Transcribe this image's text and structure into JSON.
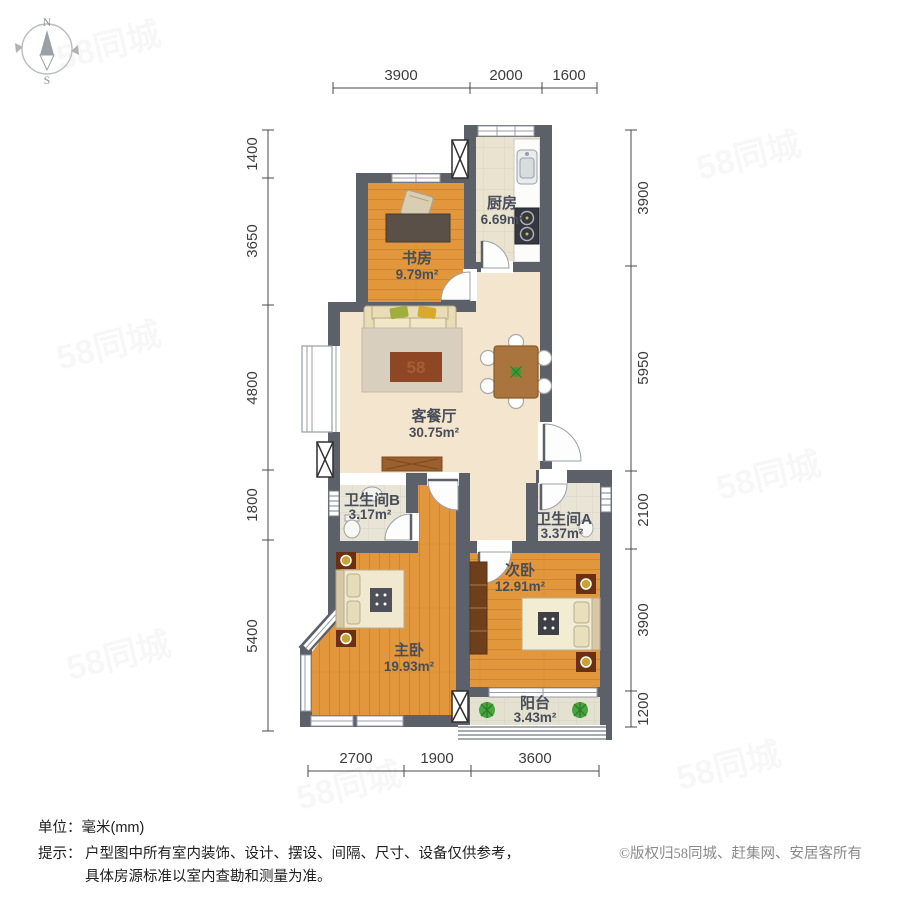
{
  "compass": {
    "north": "N",
    "south": "S"
  },
  "watermark": {
    "text": "58同城",
    "rug_text": "58"
  },
  "dimensions": {
    "top": [
      "3900",
      "2000",
      "1600"
    ],
    "left": [
      "1400",
      "3650",
      "4800",
      "1800",
      "5400"
    ],
    "right": [
      "3900",
      "5950",
      "2100",
      "3900",
      "1200"
    ],
    "bottom": [
      "2700",
      "1900",
      "3600"
    ]
  },
  "rooms": [
    {
      "name": "厨房",
      "area": "6.69m²"
    },
    {
      "name": "书房",
      "area": "9.79m²"
    },
    {
      "name": "客餐厅",
      "area": "30.75m²"
    },
    {
      "name": "卫生间B",
      "area": "3.17m²"
    },
    {
      "name": "卫生间A",
      "area": "3.37m²"
    },
    {
      "name": "次卧",
      "area": "12.91m²"
    },
    {
      "name": "主卧",
      "area": "19.93m²"
    },
    {
      "name": "阳台",
      "area": "3.43m²"
    }
  ],
  "footer": {
    "unit_label": "单位：",
    "unit_value": "毫米(mm)",
    "tip_label": "提示：",
    "tip_line1": "户型图中所有室内装饰、设计、摆设、间隔、尺寸、设备仅供参考，",
    "tip_line2": "具体房源标准以室内查勘和测量为准。",
    "copyright": "©版权归58同城、赶集网、安居客所有"
  },
  "colors": {
    "wall": "#5c6169",
    "wood": "#e2973d",
    "living_floor": "#f4e6ce",
    "tile": "#eae3d0",
    "rug_center": "#8d4724"
  }
}
